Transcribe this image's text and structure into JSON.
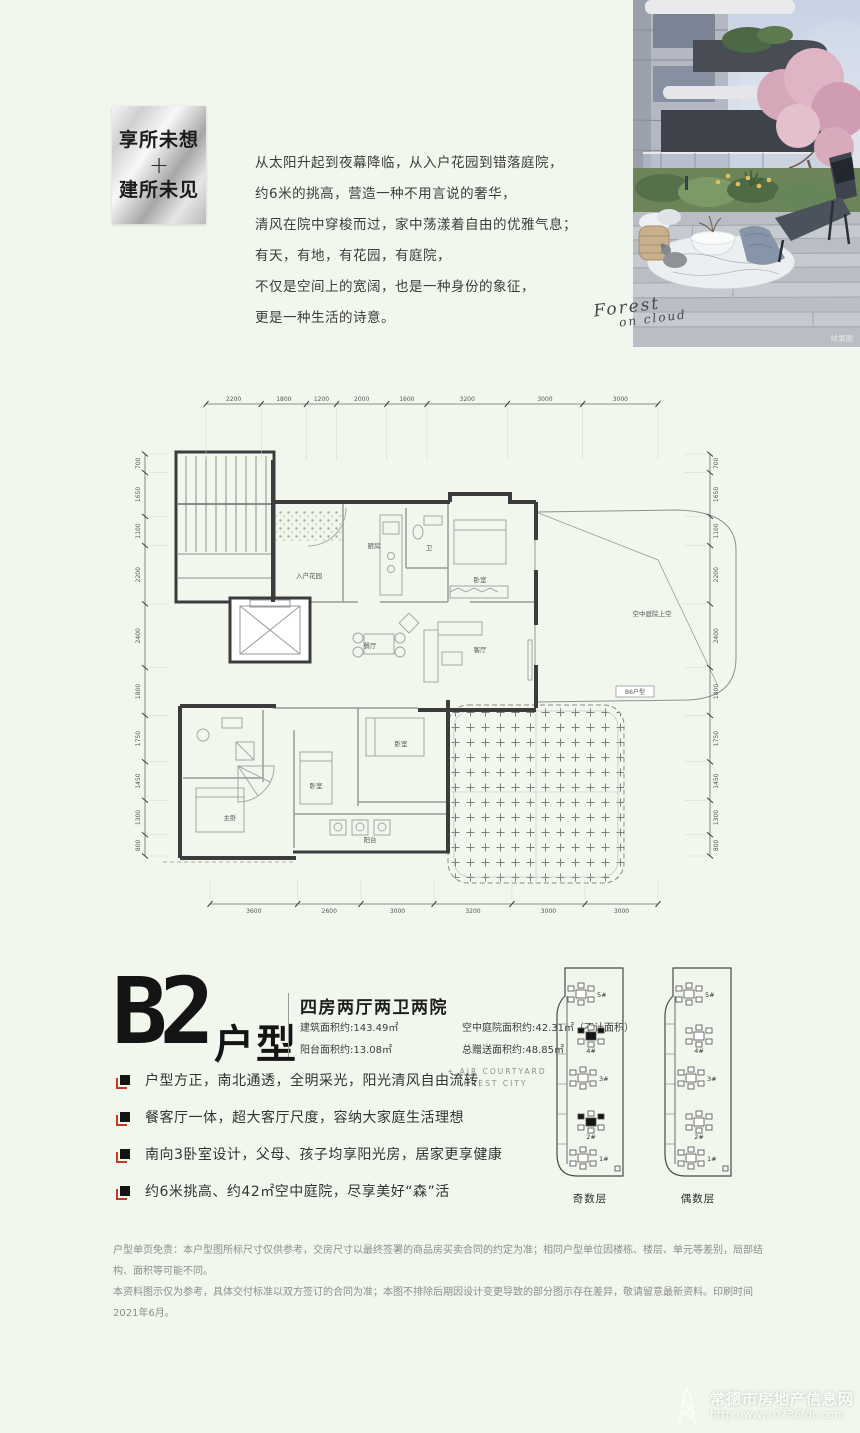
{
  "badge": {
    "line1": "享所未想",
    "plus": "+",
    "line2": "建所未见"
  },
  "intro": {
    "lines": [
      "从太阳升起到夜幕降临，从入户花园到错落庭院，",
      "约6米的挑高，营造一种不用言说的奢华，",
      "清风在院中穿梭而过，家中荡漾着自由的优雅气息；",
      "有天，有地，有花园，有庭院，",
      "不仅是空间上的宽阔，也是一种身份的象征，",
      "更是一种生活的诗意。"
    ]
  },
  "photo": {
    "caption": "效果图",
    "signature_line1": "Forest",
    "signature_line2": "on cloud"
  },
  "floorplan": {
    "dims": {
      "top": [
        2200,
        1800,
        1200,
        2000,
        1600,
        3200,
        3000,
        3000
      ],
      "bottom": [
        3600,
        2600,
        3000,
        3200,
        3000,
        3000
      ],
      "left": [
        700,
        1650,
        1100,
        2200,
        2400,
        1800,
        1750,
        1450,
        1300,
        800
      ],
      "right": [
        700,
        1650,
        1100,
        2200,
        2400,
        1800,
        1750,
        1450,
        1300,
        800
      ]
    },
    "rooms": [
      "入户花园",
      "厨房",
      "卫",
      "卧室",
      "餐厅",
      "客厅",
      "主卧",
      "卧室",
      "卧室",
      "阳台",
      "空中庭院上空"
    ],
    "adjacent_unit_label": "B6户型"
  },
  "unit": {
    "code": "B2",
    "type_suffix": "户型",
    "subtitle": "四房两厅两卫两院",
    "stats": [
      "建筑面积约:143.49㎡",
      "空中庭院面积约:42.31㎡（不计面积）",
      "阳台面积约:13.08㎡",
      "总赠送面积约:48.85㎡"
    ],
    "side_note_line1": "+ AIR COURTYARD",
    "side_note_line2": "FOREST CITY",
    "bullets": [
      "户型方正，南北通透，全明采光，阳光清风自由流转",
      "餐客厅一体，超大客厅尺度，容纳大家庭生活理想",
      "南向3卧室设计，父母、孩子均享阳光房，居家更享健康",
      "约6米挑高、约42㎡空中庭院，尽享美好“森”活"
    ]
  },
  "site": {
    "panels": [
      {
        "caption": "奇数层",
        "towers": [
          "5#",
          "4#",
          "3#",
          "2#",
          "1#"
        ],
        "highlighted": [
          "4#",
          "2#"
        ]
      },
      {
        "caption": "偶数层",
        "towers": [
          "5#",
          "4#",
          "3#",
          "2#",
          "1#"
        ],
        "highlighted": []
      }
    ]
  },
  "disclaimer": {
    "line1": "户型单页免责：本户型图所标尺寸仅供参考，交房尺寸以最终签署的商品房买卖合同的约定为准；相同户型单位因楼栋、楼层、单元等差别，局部结构、面积等可能不同。",
    "line2": "本资料图示仅为参考，具体交付标准以双方签订的合同为准；本图不排除后期因设计变更导致的部分图示存在差异，敬请留意最新资料。印刷时间2021年6月。"
  },
  "watermark": {
    "title": "常德市房地产信息网",
    "url": "http://www.0736fdc.com"
  }
}
